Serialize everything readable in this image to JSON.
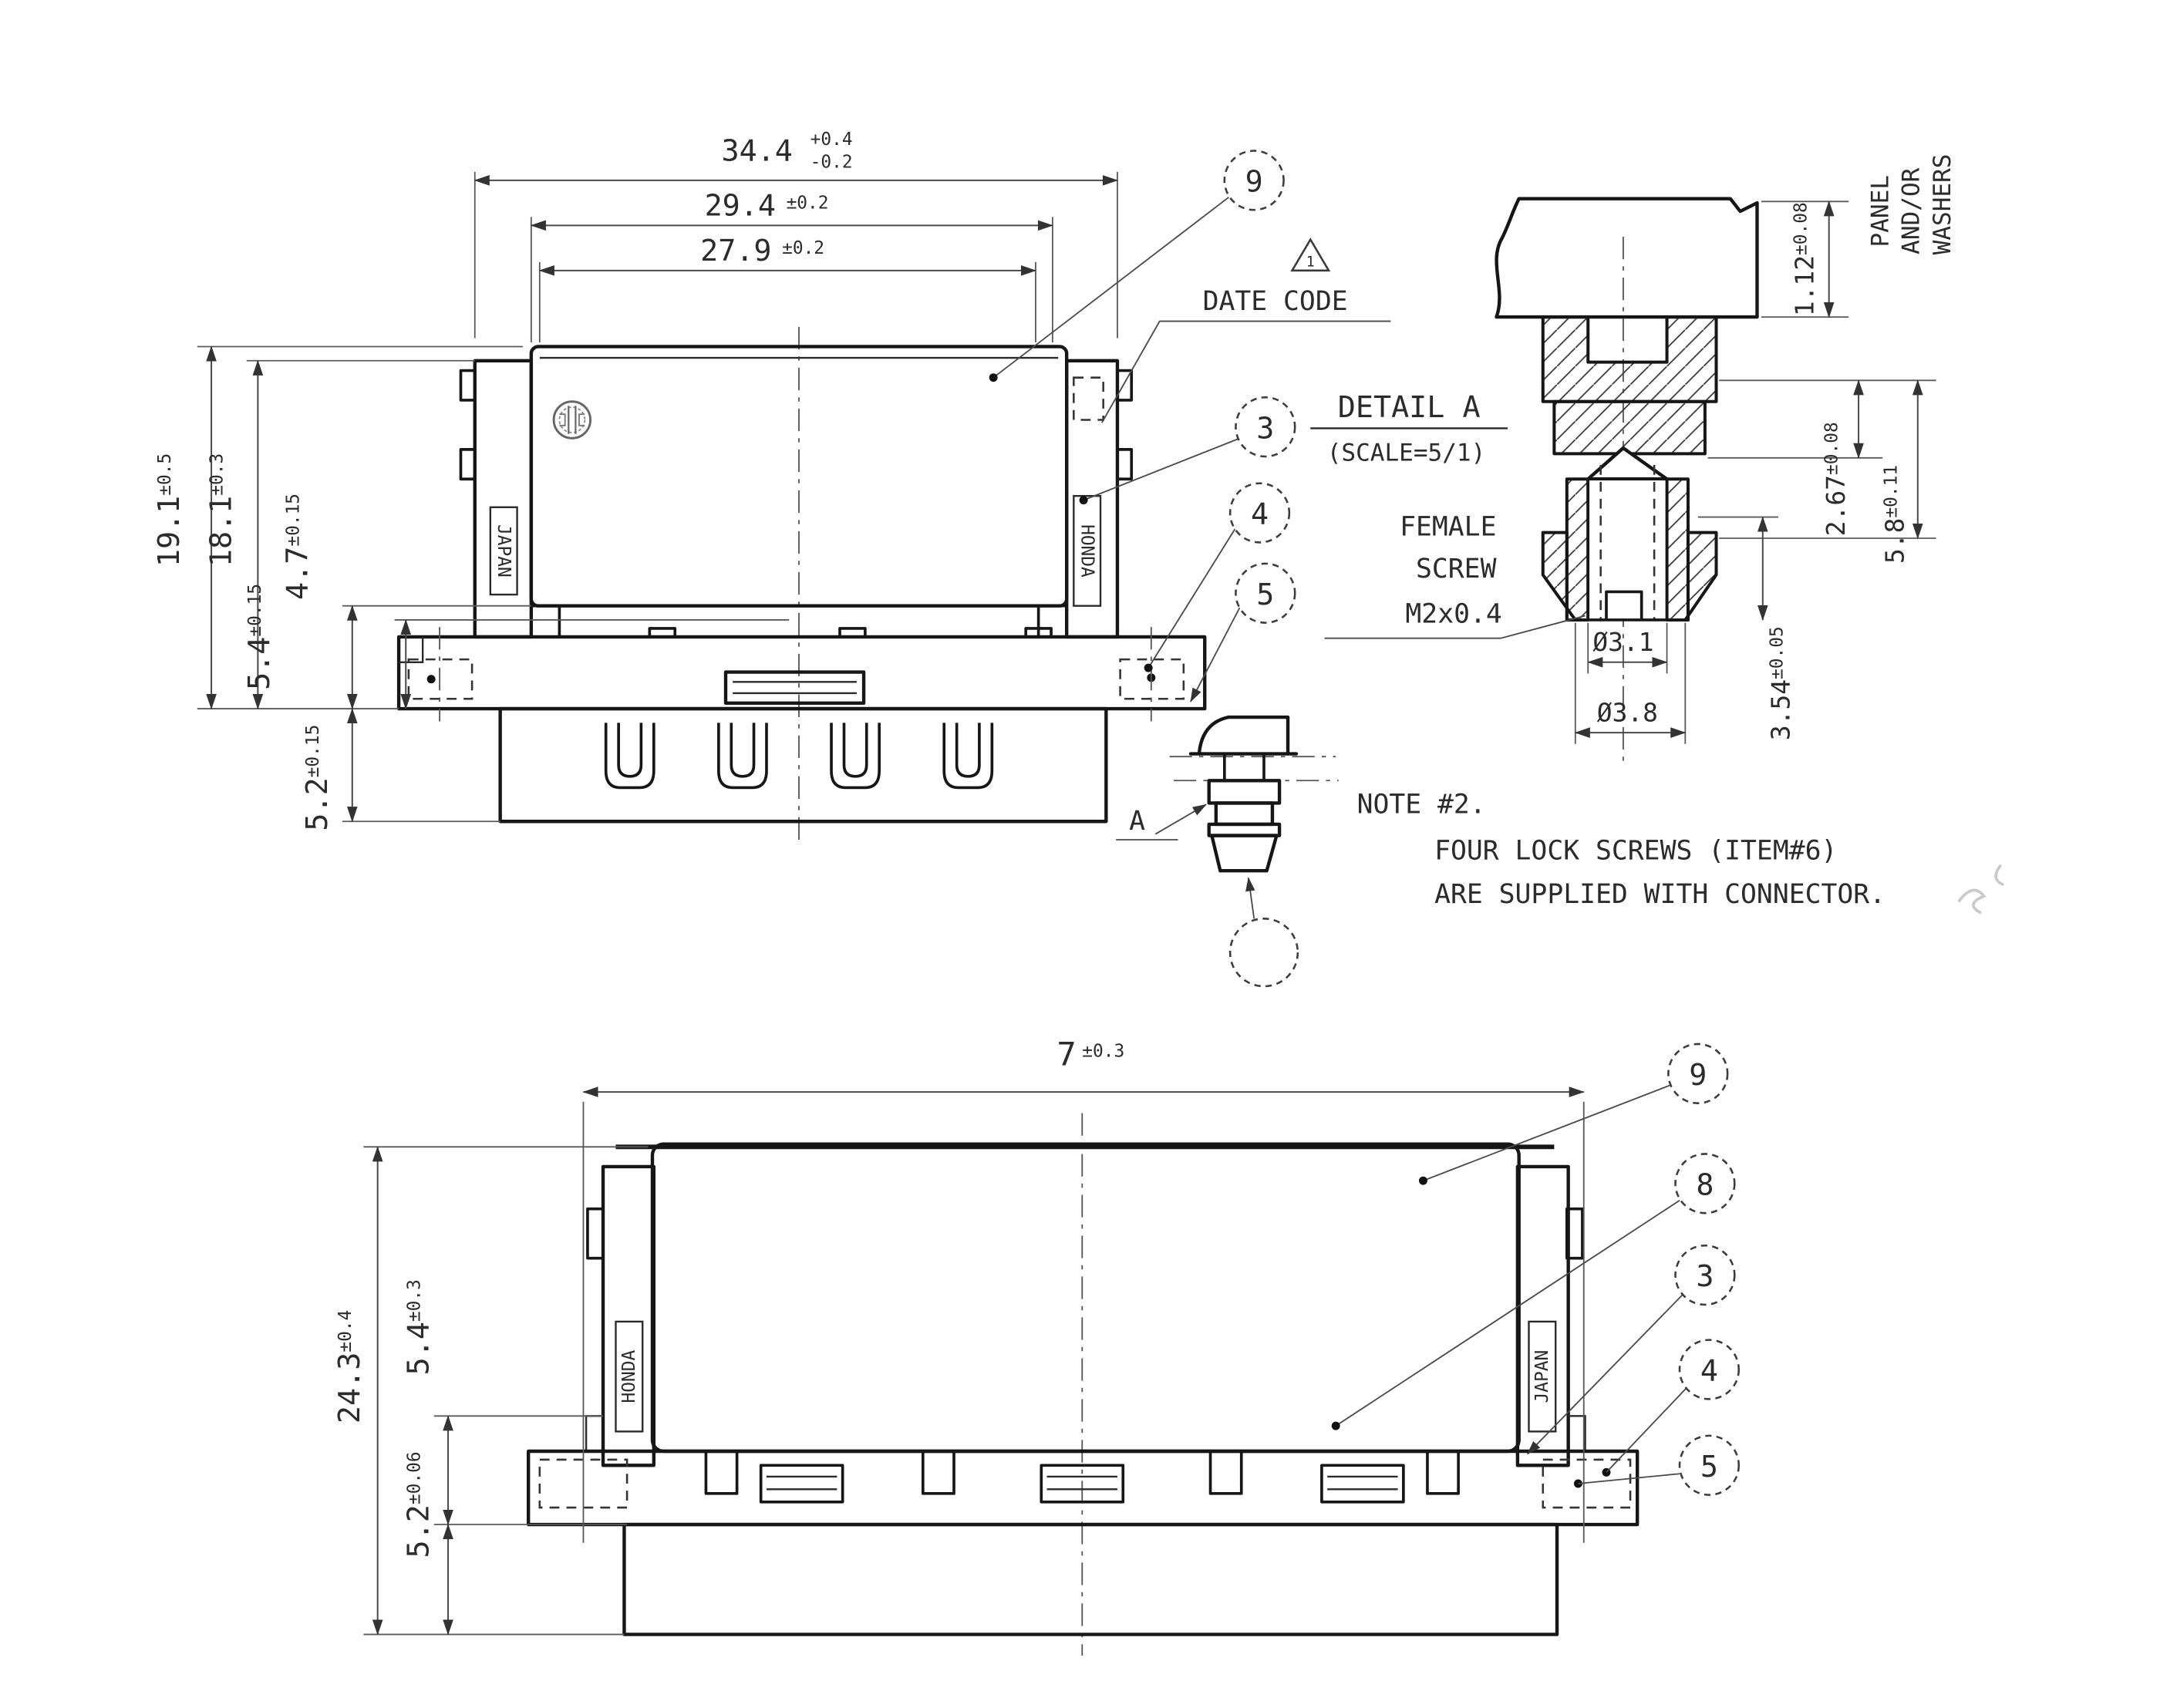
{
  "drawing": {
    "top_view": {
      "dims": {
        "w344": {
          "v": "34.4",
          "tol_up": "+0.4",
          "tol_dn": "-0.2"
        },
        "w294": {
          "v": "29.4",
          "tol": "±0.2"
        },
        "w279": {
          "v": "27.9",
          "tol": "±0.2"
        },
        "h191": {
          "v": "19.1",
          "tol": "±0.5"
        },
        "h181": {
          "v": "18.1",
          "tol": "±0.3"
        },
        "h47": {
          "v": "4.7",
          "tol": "±0.15"
        },
        "h54": {
          "v": "5.4",
          "tol": "±0.15"
        },
        "h52": {
          "v": "5.2",
          "tol": "±0.15"
        }
      },
      "labels": {
        "japan": "JAPAN",
        "honda": "HONDA",
        "date_code": "DATE CODE",
        "tri": "1",
        "a_marker": "A"
      },
      "balloons": {
        "b9": "9",
        "b3": "3",
        "b4": "4",
        "b5": "5"
      }
    },
    "detail_a": {
      "title": "DETAIL A",
      "scale": "(SCALE=5/1)",
      "panel_note_l1": "PANEL",
      "panel_note_l2": "AND/OR",
      "panel_note_l3": "WASHERS",
      "screw_l1": "FEMALE",
      "screw_l2": "SCREW",
      "screw_l3": "M2x0.4",
      "dims": {
        "t112": {
          "v": "1.12",
          "tol": "±0.08"
        },
        "t267": {
          "v": "2.67",
          "tol": "±0.08"
        },
        "t58": {
          "v": "5.8",
          "tol": "±0.11"
        },
        "t354": {
          "v": "3.54",
          "tol": "±0.05"
        },
        "d31": "Ø3.1",
        "d38": "Ø3.8"
      }
    },
    "note": {
      "l1": "NOTE #2.",
      "l2": "FOUR LOCK SCREWS (ITEM#6)",
      "l3": "ARE SUPPLIED WITH CONNECTOR."
    },
    "bottom_view": {
      "dims": {
        "w7": {
          "v": "7",
          "tol": "±0.3"
        },
        "h243": {
          "v": "24.3",
          "tol": "±0.4"
        },
        "h54": {
          "v": "5.4",
          "tol": "±0.3"
        },
        "h52": {
          "v": "5.2",
          "tol": "±0.06"
        }
      },
      "labels": {
        "honda": "HONDA",
        "japan": "JAPAN"
      },
      "balloons": {
        "b9": "9",
        "b8": "8",
        "b3": "3",
        "b4": "4",
        "b5": "5"
      }
    }
  }
}
